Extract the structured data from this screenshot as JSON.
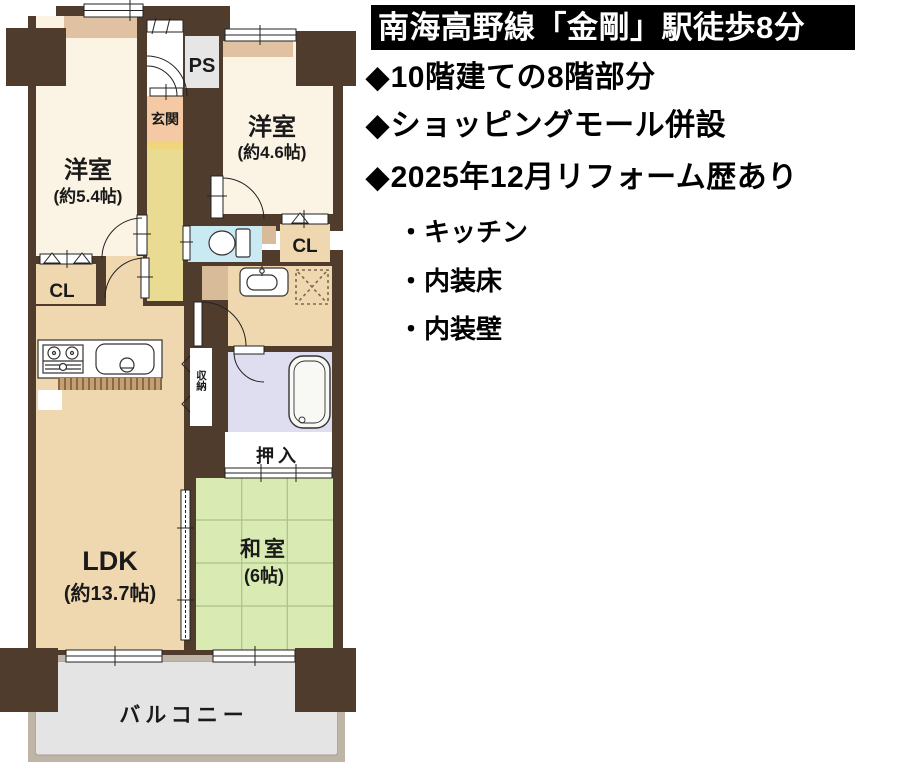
{
  "info": {
    "banner": "南海高野線「金剛」駅徒歩8分",
    "features": [
      {
        "bullet": "◆",
        "text": "10階建ての8階部分"
      },
      {
        "bullet": "◆",
        "text": "ショッピングモール併設"
      },
      {
        "bullet": "◆",
        "text": "2025年12月リフォーム歴あり"
      }
    ],
    "sub_items": [
      {
        "bullet": "・",
        "text": "キッチン"
      },
      {
        "bullet": "・",
        "text": "内装床"
      },
      {
        "bullet": "・",
        "text": "内装壁"
      }
    ]
  },
  "floorplan": {
    "rooms": {
      "western1": {
        "name": "洋室",
        "size": "(約5.4帖)"
      },
      "western2": {
        "name": "洋室",
        "size": "(約4.6帖)"
      },
      "ldk": {
        "name": "LDK",
        "size": "(約13.7帖)"
      },
      "japanese": {
        "name": "和室",
        "size": "(6帖)"
      },
      "entrance": {
        "label": "玄関"
      },
      "ps": {
        "label": "PS"
      },
      "closet_left": {
        "label": "CL"
      },
      "closet_right": {
        "label": "CL"
      },
      "storage": {
        "label": "収納"
      },
      "oshiire": {
        "label": "押入"
      },
      "balcony": {
        "label": "バルコニー"
      }
    },
    "colors": {
      "wall": "#4F3C2C",
      "western_room": "#FBF4E5",
      "ldk": "#EFD7B0",
      "tatami": "#D9EBB3",
      "hall": "#EADB93",
      "entrance": "#F4C9A3",
      "toilet": "#C9E9F3",
      "bath": "#DEDEF0",
      "balcony_floor": "#E4E4E4",
      "balcony_wall": "#BFB5A7",
      "ps": "#E6E6E6",
      "closet": "#EFD7B0"
    }
  }
}
